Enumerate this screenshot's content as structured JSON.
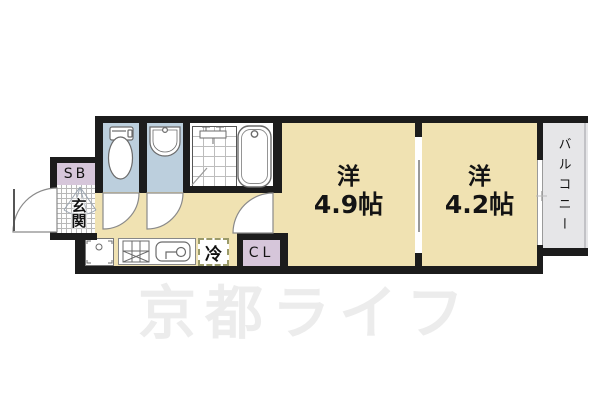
{
  "floorplan": {
    "watermark": "京都ライフ",
    "labels": {
      "shoe_box": "SB",
      "entrance": "玄関",
      "room1_name": "洋",
      "room1_size": "4.9帖",
      "room2_name": "洋",
      "room2_size": "4.2帖",
      "balcony": "バルコニー",
      "closet": "CL",
      "refrigerator": "冷"
    },
    "colors": {
      "wall": "#1c1c1c",
      "room_floor": "#f0e2b2",
      "wet_area": "#bccfdd",
      "storage": "#d6c6da",
      "balcony": "#e6e6e8",
      "watermark": "#ececec"
    }
  }
}
